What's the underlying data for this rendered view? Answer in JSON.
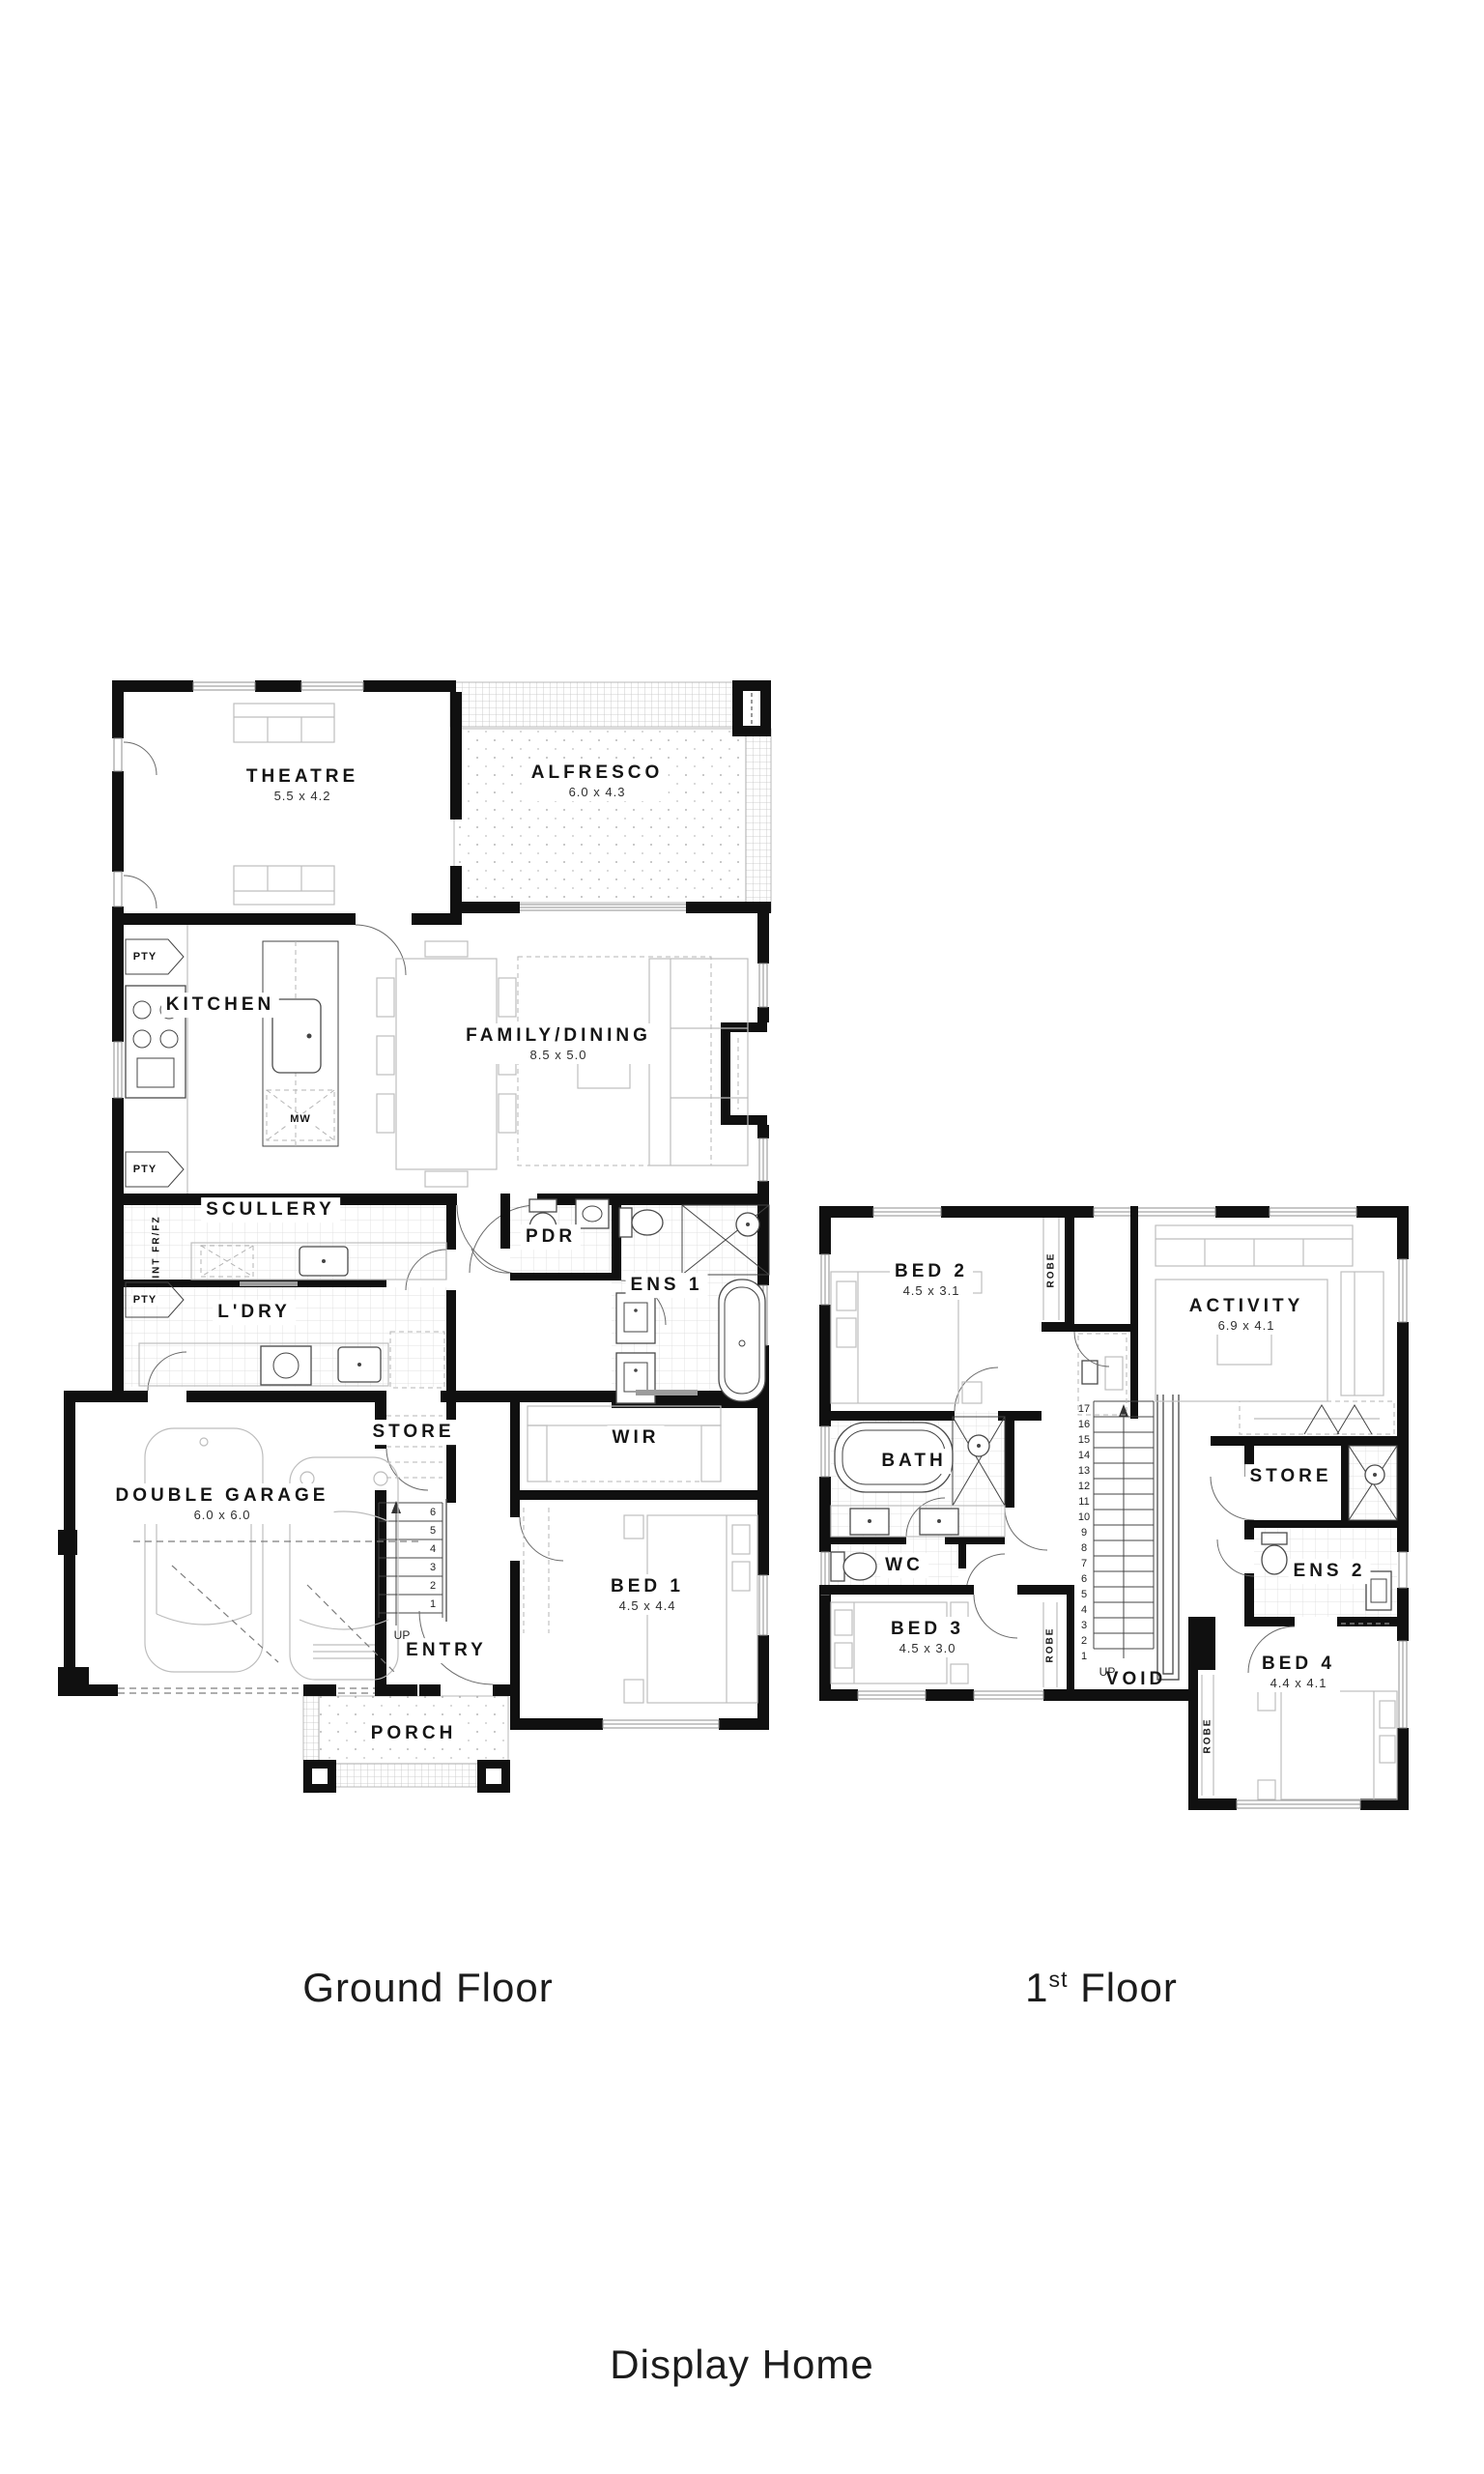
{
  "page": {
    "wall_color": "#101010",
    "furniture_color": "#bdbdbd",
    "background": "#ffffff"
  },
  "ground_floor": {
    "caption": "Ground Floor",
    "rooms": {
      "theatre": {
        "name": "THEATRE",
        "dims": "5.5 x 4.2"
      },
      "alfresco": {
        "name": "ALFRESCO",
        "dims": "6.0 x 4.3"
      },
      "kitchen": {
        "name": "KITCHEN"
      },
      "family_dining": {
        "name": "FAMILY/DINING",
        "dims": "8.5 x 5.0"
      },
      "scullery": {
        "name": "SCULLERY"
      },
      "ldry": {
        "name": "L'DRY"
      },
      "pdr": {
        "name": "PDR"
      },
      "ens1": {
        "name": "ENS 1"
      },
      "store": {
        "name": "STORE"
      },
      "wir": {
        "name": "WIR"
      },
      "garage": {
        "name": "DOUBLE GARAGE",
        "dims": "6.0 x 6.0"
      },
      "entry": {
        "name": "ENTRY"
      },
      "bed1": {
        "name": "BED 1",
        "dims": "4.5 x 4.4"
      },
      "porch": {
        "name": "PORCH"
      }
    },
    "annotations": {
      "pty_top": "PTY",
      "pty_mid": "PTY",
      "pty_bottom": "PTY",
      "int_fridge": "INT FR/FZ",
      "microwave": "MW",
      "up": "UP",
      "stair_numbers": [
        "6",
        "5",
        "4",
        "3",
        "2",
        "1"
      ]
    }
  },
  "first_floor": {
    "caption_prefix": "1",
    "caption_sup": "st",
    "caption_suffix": " Floor",
    "rooms": {
      "bed2": {
        "name": "BED 2",
        "dims": "4.5 x 3.1"
      },
      "activity": {
        "name": "ACTIVITY",
        "dims": "6.9 x 4.1"
      },
      "bath": {
        "name": "BATH"
      },
      "wc": {
        "name": "WC"
      },
      "store": {
        "name": "STORE"
      },
      "ens2": {
        "name": "ENS 2"
      },
      "bed3": {
        "name": "BED 3",
        "dims": "4.5 x 3.0"
      },
      "void": {
        "name": "VOID"
      },
      "bed4": {
        "name": "BED 4",
        "dims": "4.4 x 4.1"
      }
    },
    "annotations": {
      "robe_bed2": "ROBE",
      "robe_bed3": "ROBE",
      "robe_bed4": "ROBE",
      "up": "UP",
      "stair_numbers": [
        "17",
        "16",
        "15",
        "14",
        "13",
        "12",
        "11",
        "10",
        "9",
        "8",
        "7",
        "6",
        "5",
        "4",
        "3",
        "2",
        "1"
      ]
    }
  },
  "footer": {
    "title": "Display Home"
  }
}
